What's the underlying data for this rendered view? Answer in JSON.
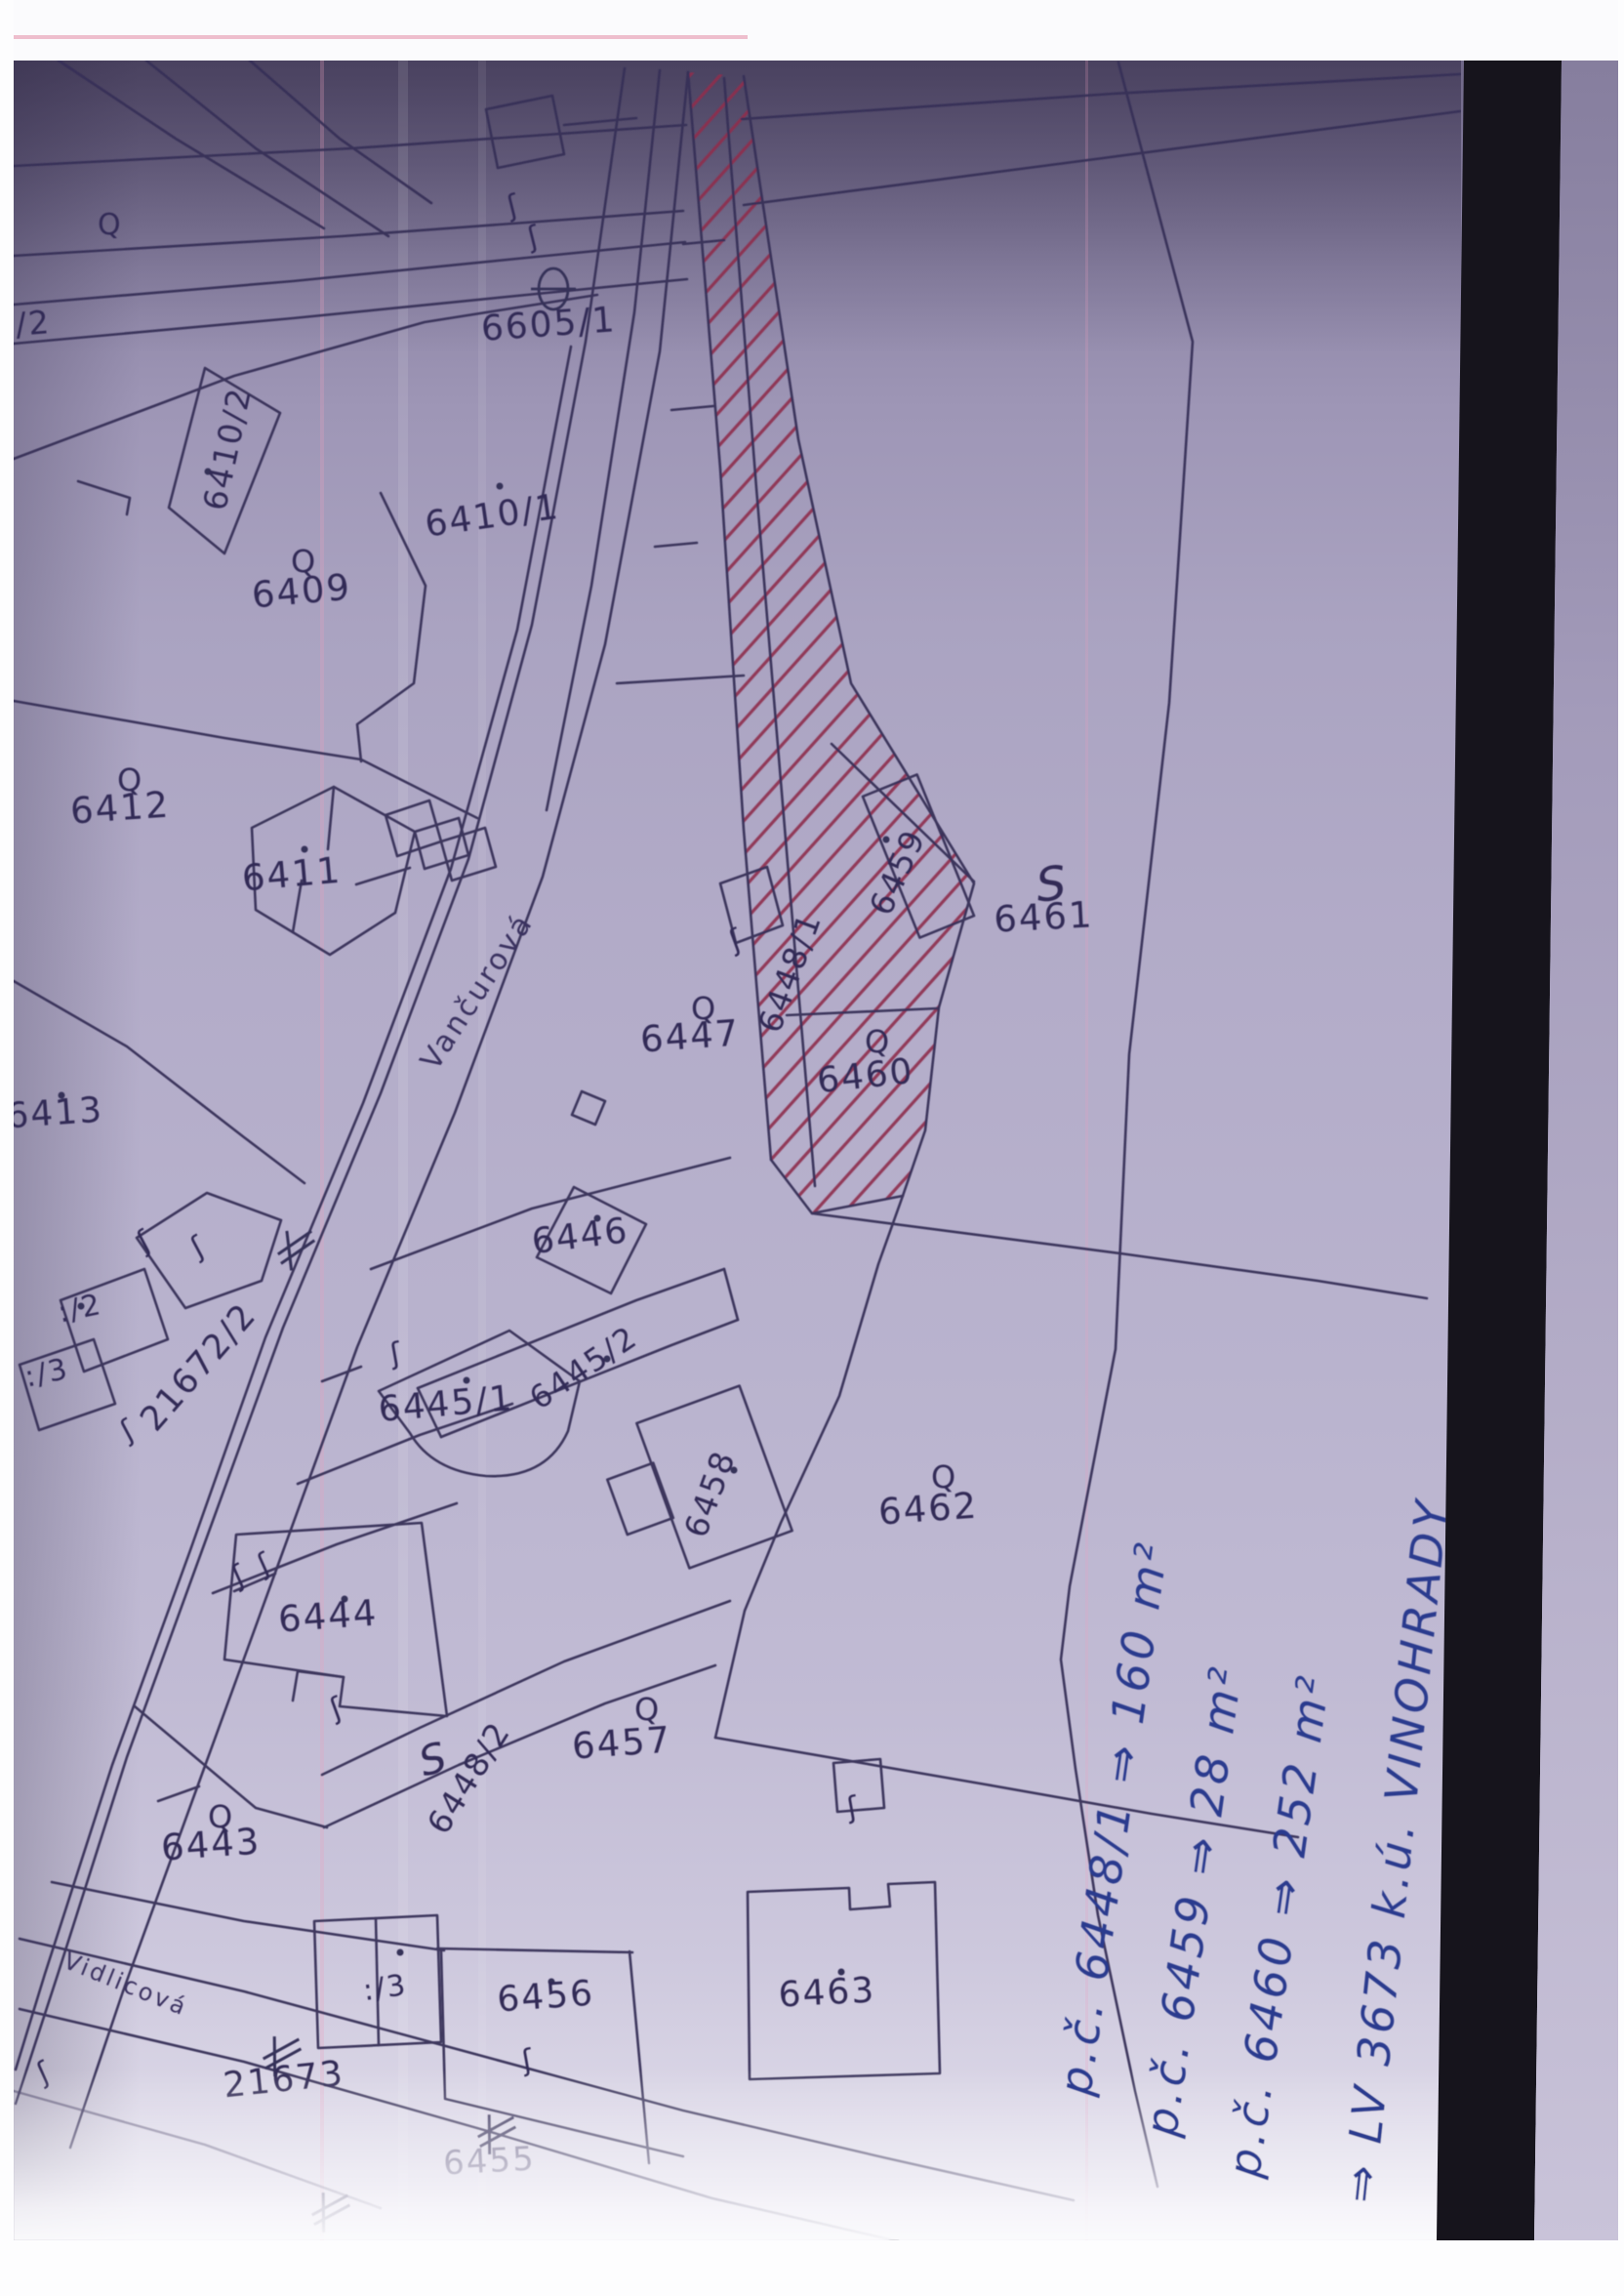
{
  "page": {
    "background": "#fbfbfd",
    "scan_tint": "#b0a9c5",
    "ink_color": "#363058",
    "hatch_red": "#8e2f4d",
    "pen_blue": "#2c3a8e",
    "band_black": "#16141c"
  },
  "map": {
    "streets": [
      {
        "text": "Vančurová"
      },
      {
        "text": "Vidlicová"
      }
    ],
    "parcels": [
      {
        "text": "6605/1"
      },
      {
        "text": "6410/2"
      },
      {
        "text": "6410/1"
      },
      {
        "text": "6409"
      },
      {
        "text": "6412"
      },
      {
        "text": "6411"
      },
      {
        "text": "6413"
      },
      {
        "text": "7/2"
      },
      {
        "text": ":/2"
      },
      {
        "text": ":/3"
      },
      {
        "text": "21672/2"
      },
      {
        "text": "6447"
      },
      {
        "text": "6448/1"
      },
      {
        "text": "6459"
      },
      {
        "text": "6460"
      },
      {
        "text": "6461"
      },
      {
        "text": "6446"
      },
      {
        "text": "6445/2"
      },
      {
        "text": "6445/1"
      },
      {
        "text": "6458"
      },
      {
        "text": "6444"
      },
      {
        "text": "6462"
      },
      {
        "text": "6448/2"
      },
      {
        "text": "6457"
      },
      {
        "text": "6443"
      },
      {
        "text": "6456"
      },
      {
        "text": ":/3"
      },
      {
        "text": "6463"
      },
      {
        "text": "21673"
      },
      {
        "text": "6455"
      }
    ],
    "symbols": {
      "tree_mark": "Q",
      "slope_mark": "S",
      "boundary_mark": "ʃ"
    },
    "notes": [
      "p.č. 6448/1 ⇒ 160 m²",
      "p.č. 6459 ⇒ 28 m²",
      "p.č. 6460 ⇒ 252 m²",
      "⇒ LV 3673 k.ú. VINOHRADY"
    ]
  }
}
